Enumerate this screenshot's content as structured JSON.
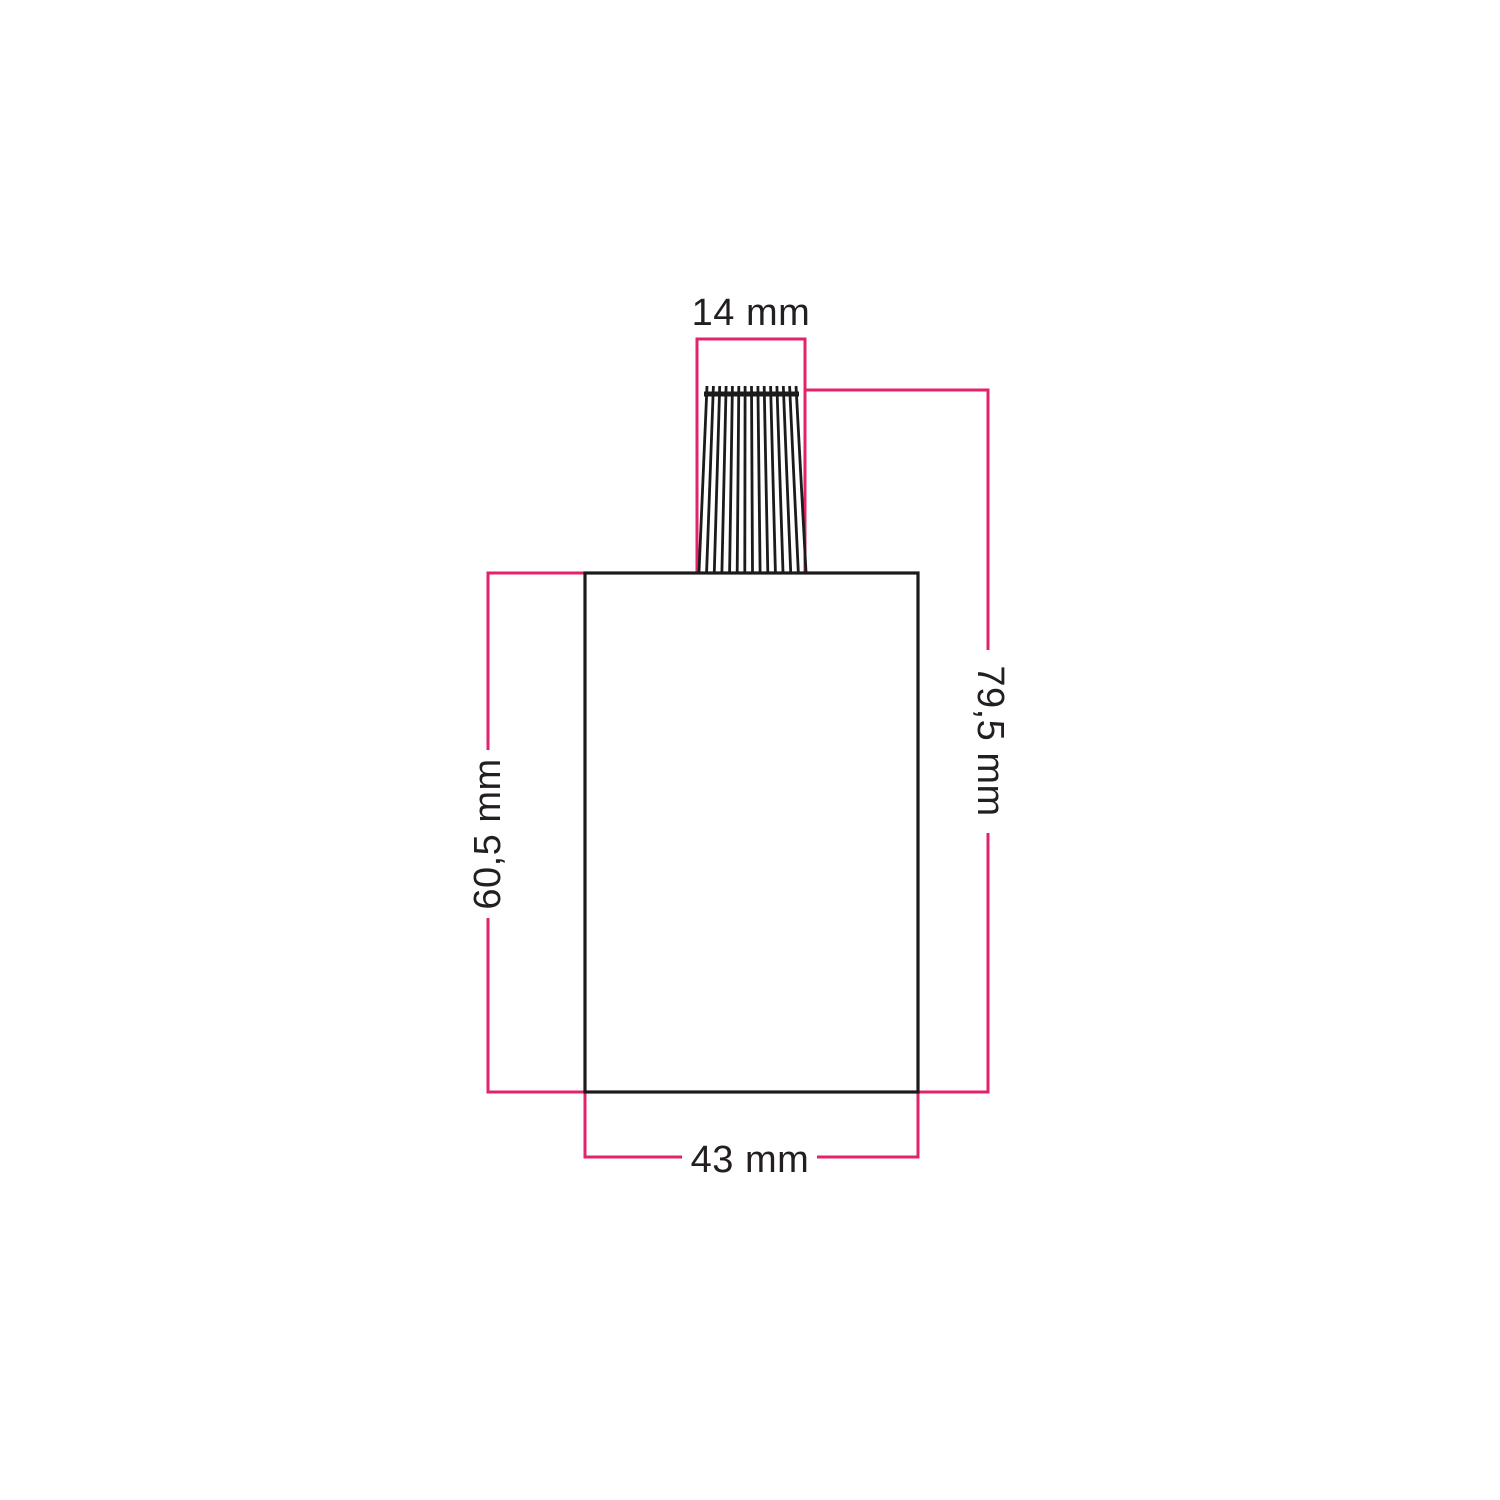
{
  "drawing": {
    "type": "technical-dimension-drawing",
    "units": "mm",
    "labels": {
      "top_width": "14 mm",
      "total_height": "79,5 mm",
      "body_height": "60,5 mm",
      "body_width": "43 mm"
    },
    "values_mm": {
      "top_width": 14,
      "total_height": 79.5,
      "body_height": 60.5,
      "body_width": 43
    },
    "colors": {
      "dimension_line": "#E2226B",
      "outline": "#1B1B1B",
      "label_text": "#231F20",
      "background": "#FFFFFF"
    }
  }
}
